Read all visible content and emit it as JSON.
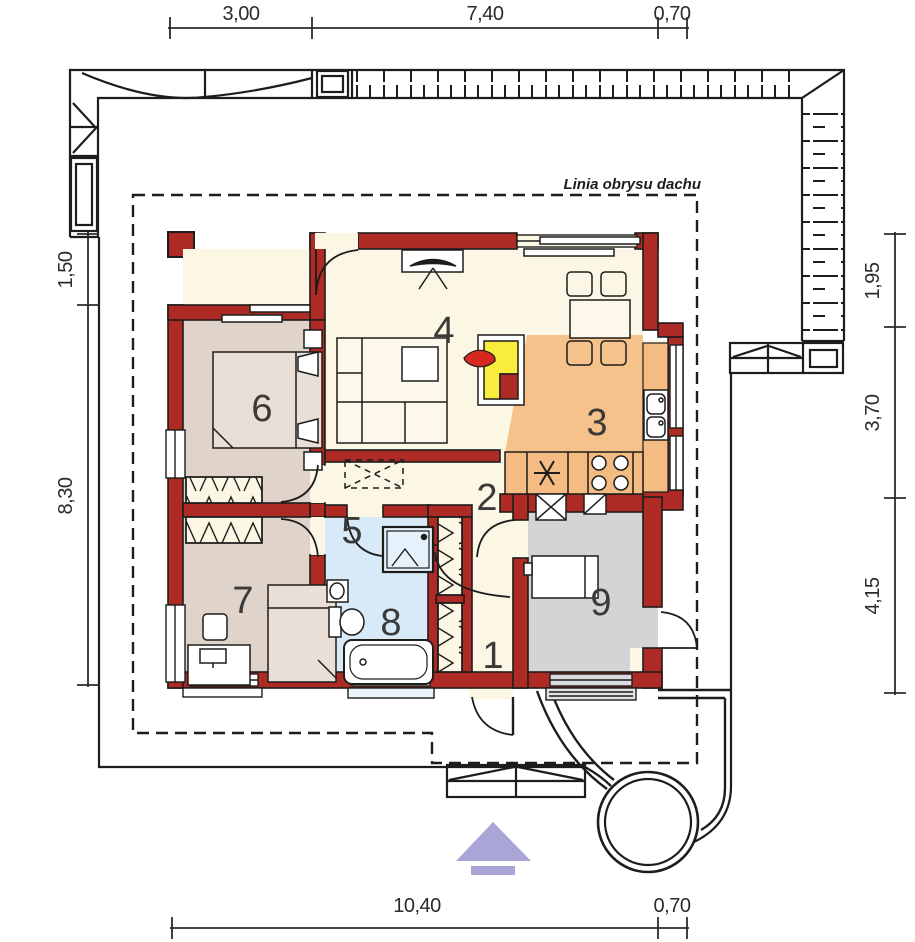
{
  "plan": {
    "roof_label": "Linia obrysu dachu",
    "rooms": [
      {
        "number": "1",
        "color": "#fcf6e4"
      },
      {
        "number": "2",
        "color": "#fcf6e4"
      },
      {
        "number": "3",
        "color": "#f6c28c"
      },
      {
        "number": "4",
        "color": "#fcf6e4"
      },
      {
        "number": "5",
        "color": "#fcf6e4"
      },
      {
        "number": "6",
        "color": "#e0d3c9"
      },
      {
        "number": "7",
        "color": "#e0d3c9"
      },
      {
        "number": "8",
        "color": "#d8eaf8"
      },
      {
        "number": "9",
        "color": "#d3d4d6"
      }
    ],
    "dimensions": {
      "top": [
        "3,00",
        "7,40",
        "0,70"
      ],
      "bottom": [
        "10,40",
        "0,70"
      ],
      "left": [
        "1,50",
        "8,30"
      ],
      "right": [
        "1,95",
        "3,70",
        "4,15"
      ]
    },
    "colors": {
      "wall": "#ae2a24",
      "floor_cream": "#fcf6e4",
      "kitchen_orange": "#f6c28c",
      "counter_orange": "#f4bc82",
      "bedroom_taupe": "#e0d3c9",
      "bath_blue": "#d8eaf8",
      "utility_gray": "#d3d4d6",
      "fireplace_yellow": "#f8ec3d",
      "flame_red": "#d5281e",
      "north_arrow_lavender": "#a9a5d7",
      "line_dark": "#1d1d1b"
    }
  }
}
